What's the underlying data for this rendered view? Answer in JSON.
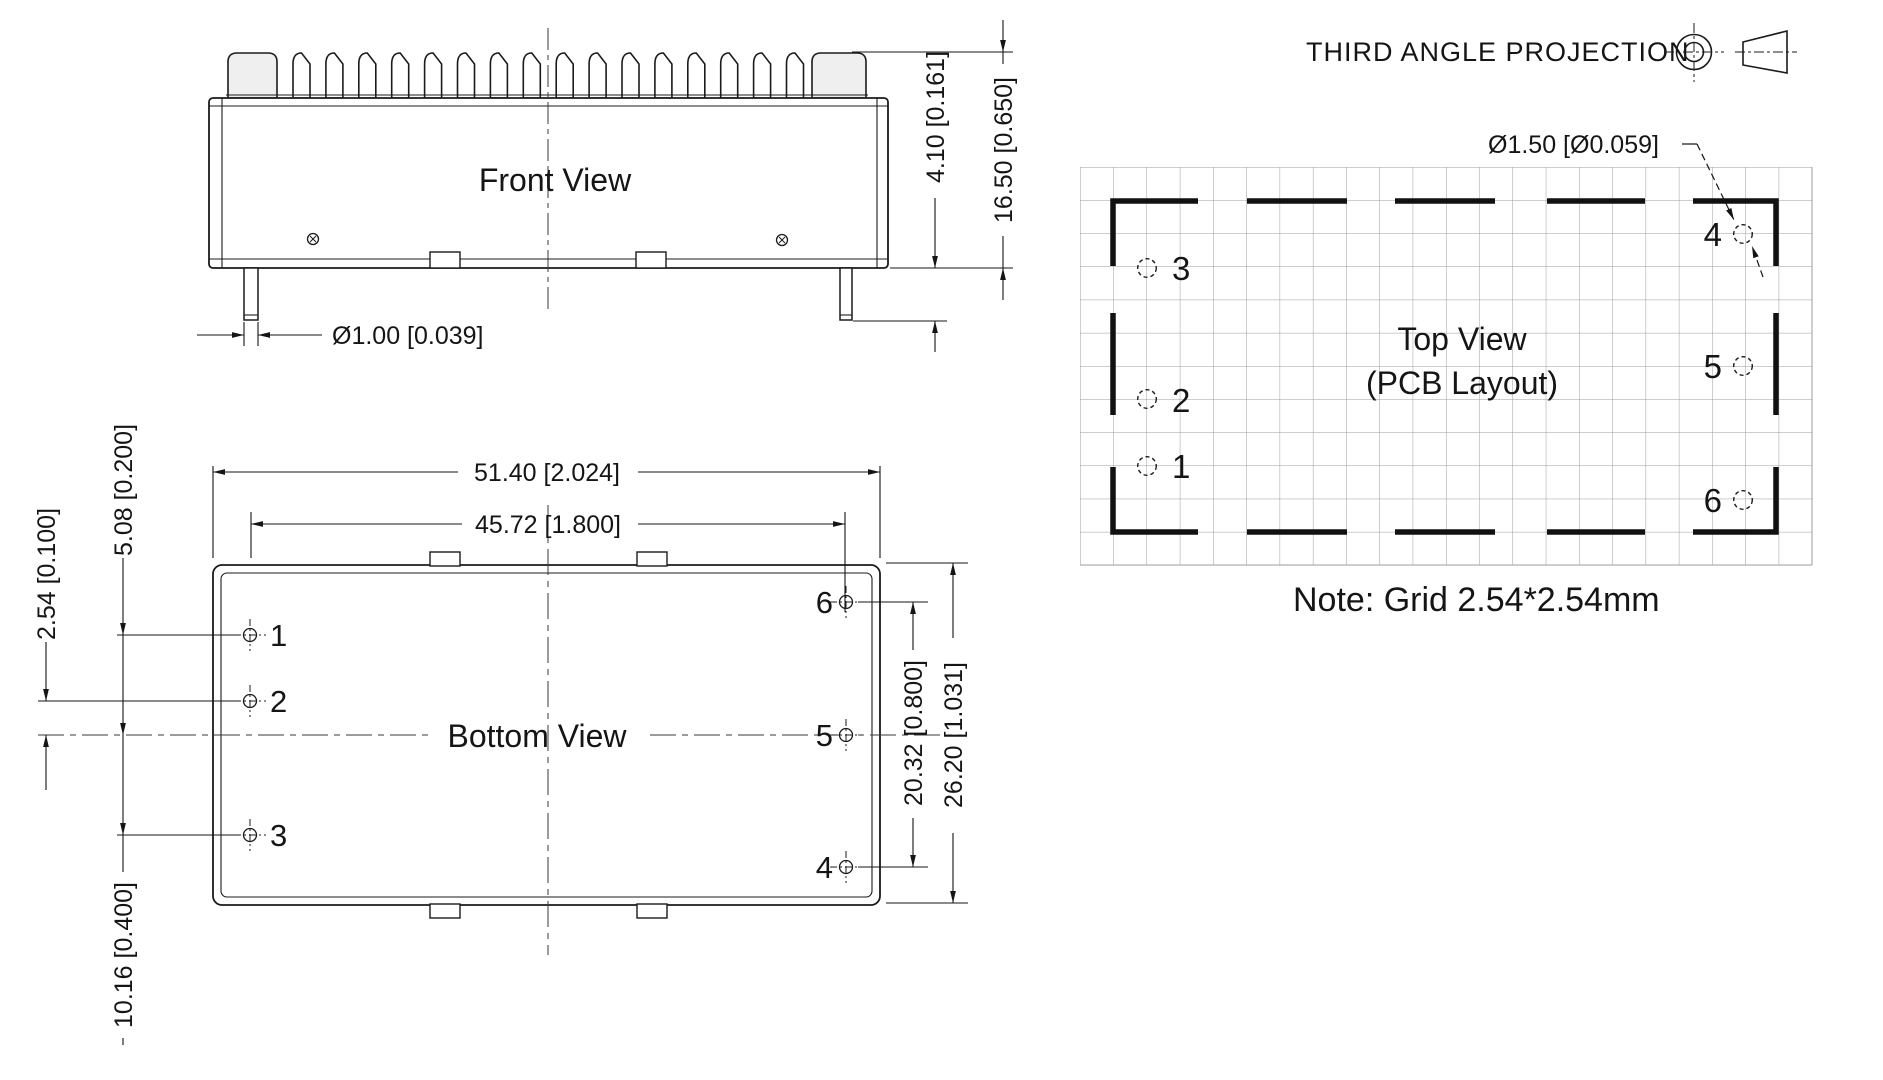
{
  "projection": {
    "label": "THIRD ANGLE PROJECTION"
  },
  "front_view": {
    "label": "Front View",
    "dims": {
      "pin_diameter": "Ø1.00 [0.039]",
      "pin_length": "4.10 [0.161]",
      "module_height": "16.50 [0.650]"
    }
  },
  "bottom_view": {
    "label": "Bottom View",
    "dims": {
      "module_length": "51.40 [2.024]",
      "pin_span_x": "45.72 [1.800]",
      "pitch_center": "2.54 [0.100]",
      "pitch_1_2": "5.08 [0.200]",
      "pitch_2_3": "10.16 [0.400]",
      "pin_span_y": "20.32 [0.800]",
      "module_width": "26.20 [1.031]"
    },
    "pins": [
      {
        "label": "1"
      },
      {
        "label": "2"
      },
      {
        "label": "3"
      },
      {
        "label": "4"
      },
      {
        "label": "5"
      },
      {
        "label": "6"
      }
    ]
  },
  "top_view": {
    "label": "Top View",
    "sublabel": "(PCB Layout)",
    "note": "Note: Grid 2.54*2.54mm",
    "dims": {
      "hole_diameter": "Ø1.50 [Ø0.059]"
    },
    "holes": [
      {
        "label": "1"
      },
      {
        "label": "2"
      },
      {
        "label": "3"
      },
      {
        "label": "4"
      },
      {
        "label": "5"
      },
      {
        "label": "6"
      }
    ]
  }
}
